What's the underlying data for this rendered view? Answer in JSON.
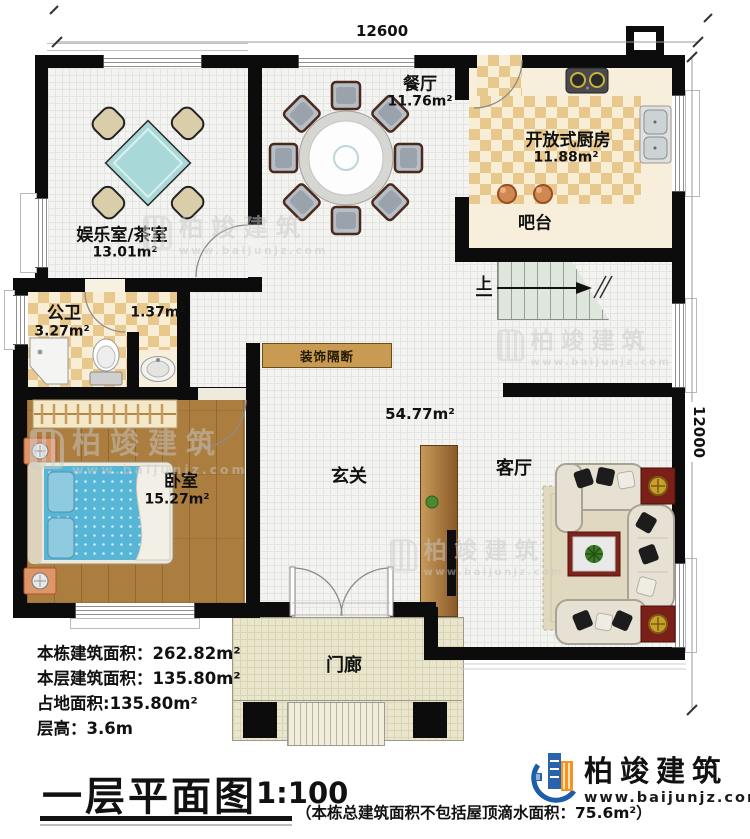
{
  "title": {
    "text": "一层平面图",
    "scale": "1:100"
  },
  "footnote": {
    "text": "（本栋总建筑面积不包括屋顶滴水面积：75.6m²）"
  },
  "dimensions": {
    "top": "12600",
    "right": "12000"
  },
  "rooms": {
    "entertainment": {
      "name": "娱乐室/茶室",
      "area": "13.01m²"
    },
    "dining": {
      "name": "餐厅",
      "area": "11.76m²"
    },
    "kitchen": {
      "name": "开放式厨房",
      "area": "11.88m²"
    },
    "bar": {
      "name": "吧台"
    },
    "stairs": {
      "name": "上"
    },
    "bath": {
      "name": "公卫",
      "area": "3.27m²"
    },
    "closet": {
      "area": "1.37m²"
    },
    "partition": {
      "name": "装饰隔断"
    },
    "bedroom": {
      "name": "卧室",
      "area": "15.27m²"
    },
    "foyer": {
      "name": "玄关"
    },
    "hall": {
      "area": "54.77m²"
    },
    "living": {
      "name": "客厅"
    },
    "porch": {
      "name": "门廊"
    }
  },
  "info": {
    "line1": "本栋建筑面积：262.82m²",
    "line2": "本层建筑面积：135.80m²",
    "line3": "占地面积:135.80m²",
    "line4": "层高：3.6m"
  },
  "logo": {
    "name": "柏竣建筑",
    "site": "www.baijunjz.com"
  },
  "watermark": {
    "name": "柏竣建筑",
    "site": "www.baijunjz.com"
  }
}
